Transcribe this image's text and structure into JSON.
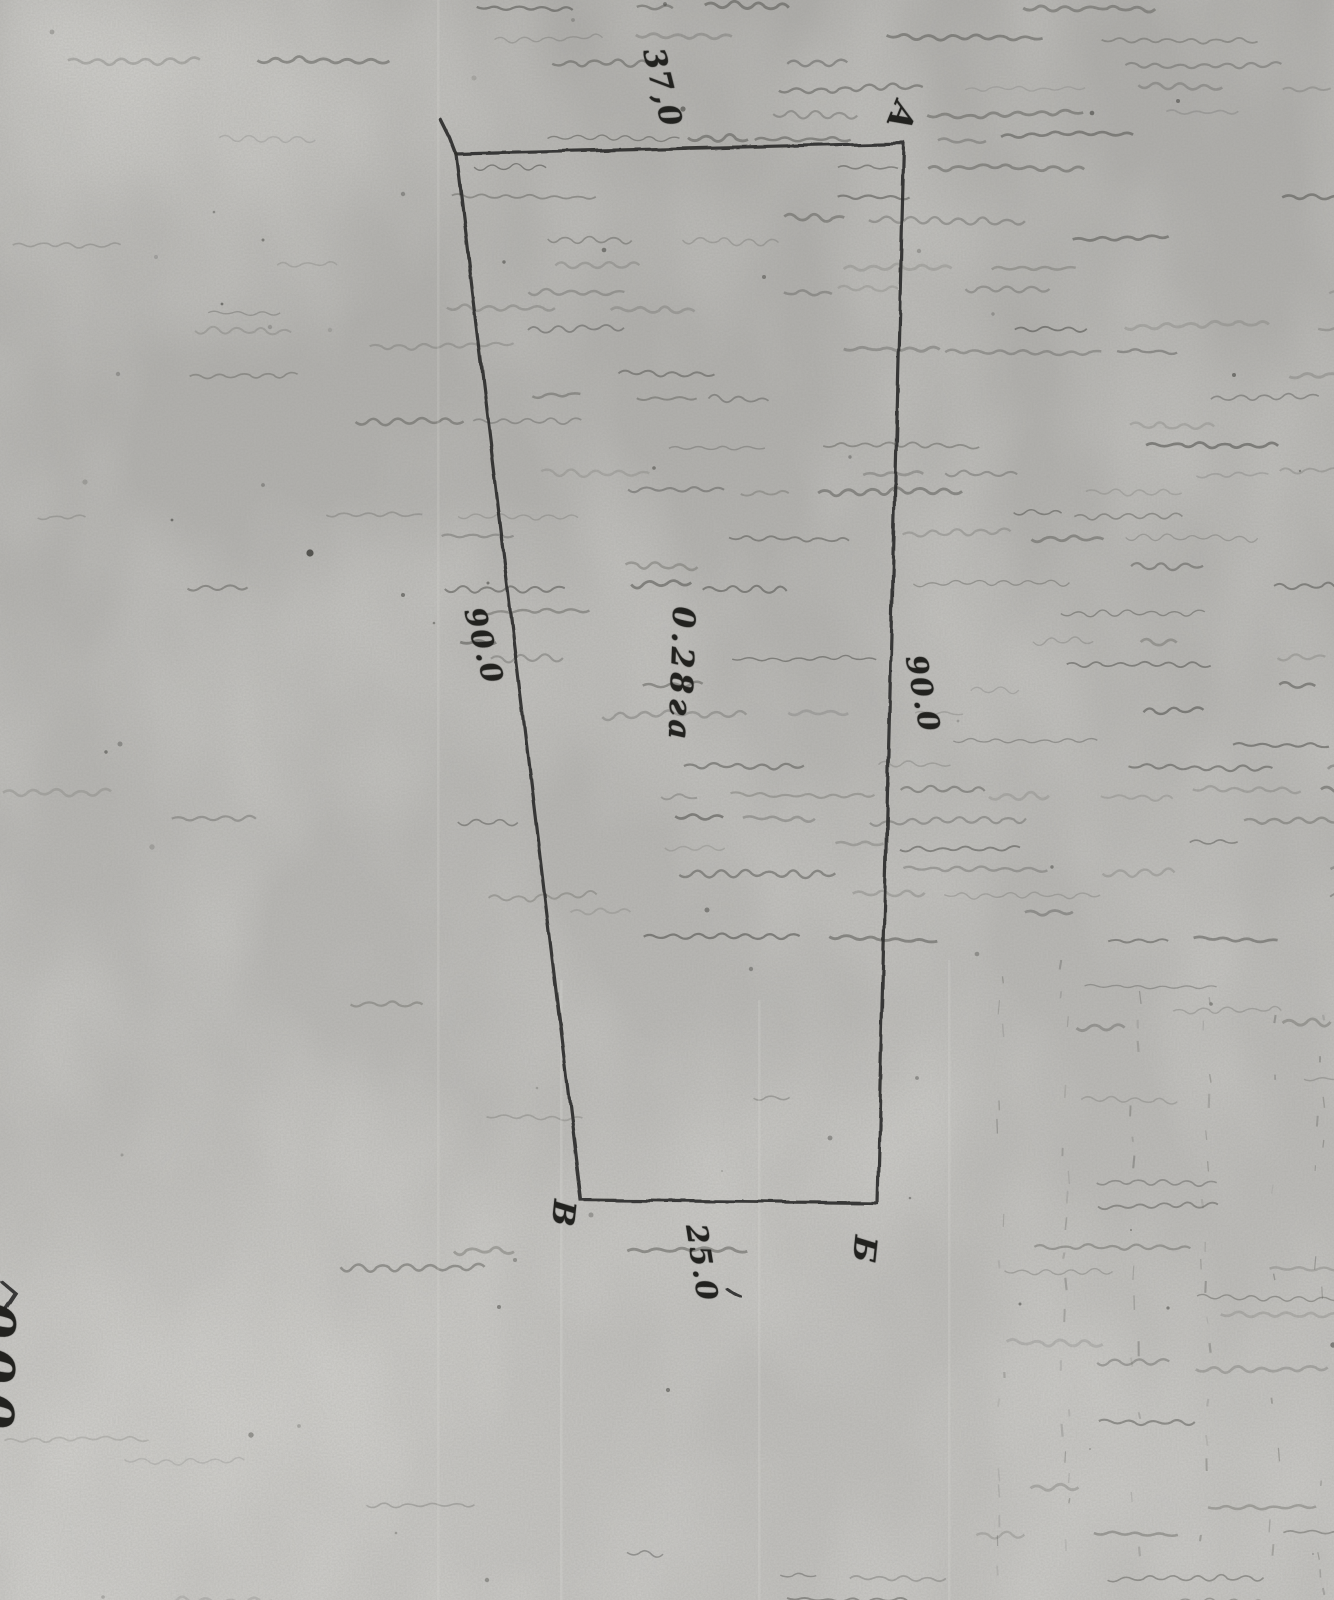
{
  "page": {
    "paper_color": "#b4b3b0",
    "ink_color": "#23231f"
  },
  "plot_plan": {
    "area_label": "0.28га",
    "side_labels": {
      "top": "37,0",
      "right": "90.0",
      "left": "90.0",
      "bottom": "25.0"
    },
    "corner_labels": {
      "top_right": "А",
      "bottom_right": "Б",
      "bottom_left": "В"
    },
    "margin_fragment": "000",
    "geometry": {
      "vertices": [
        [
          456,
          154
        ],
        [
          904,
          143
        ],
        [
          877,
          1203
        ],
        [
          581,
          1200
        ]
      ],
      "corner_tick": [
        [
          441,
          120
        ],
        [
          450,
          138
        ],
        [
          456,
          154
        ]
      ]
    }
  }
}
